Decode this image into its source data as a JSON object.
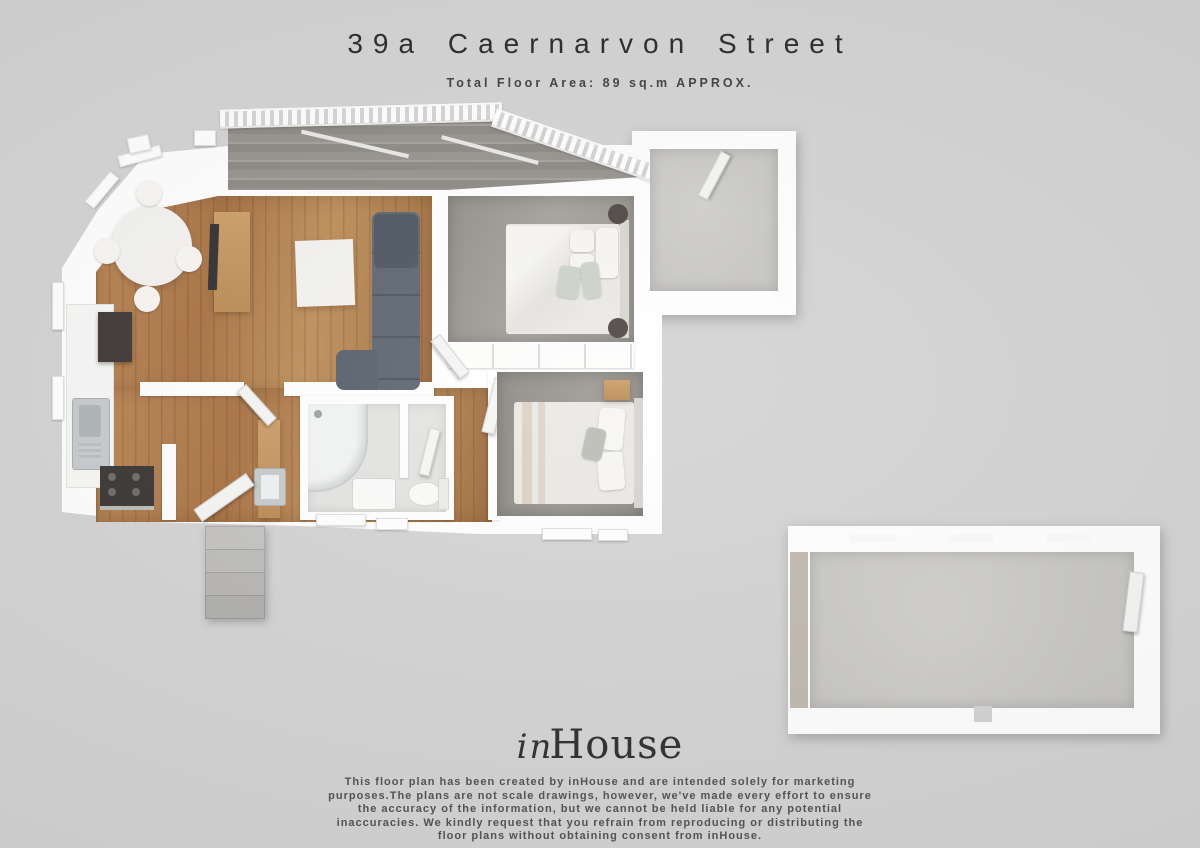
{
  "page": {
    "background": "#d3d3d3"
  },
  "header": {
    "title": "39a Caernarvon Street",
    "subtitle": "Total Floor Area: 89 sq.m APPROX."
  },
  "branding": {
    "logo_script": "in",
    "logo_serif": "House"
  },
  "disclaimer": {
    "lines": [
      "This floor plan has been created by inHouse and are intended solely for marketing",
      "purposes.The plans are not scale drawings, however, we've made every effort to ensure",
      "the accuracy of the information, but we cannot be held liable for any potential",
      "inaccuracies. We kindly request that you refrain from reproducing or distributing the",
      "floor plans without obtaining consent from inHouse."
    ]
  },
  "palette": {
    "background": "#d3d3d3",
    "wall_white": "#ffffff",
    "wood_floor": "#ad7a4b",
    "deck_grey": "#908d88",
    "carpet_grey": "#9a9791",
    "concrete_grey": "#c9c8c5",
    "sofa_slate": "#545d6a",
    "oak_furniture": "#c2945c",
    "title_text": "#262626"
  }
}
